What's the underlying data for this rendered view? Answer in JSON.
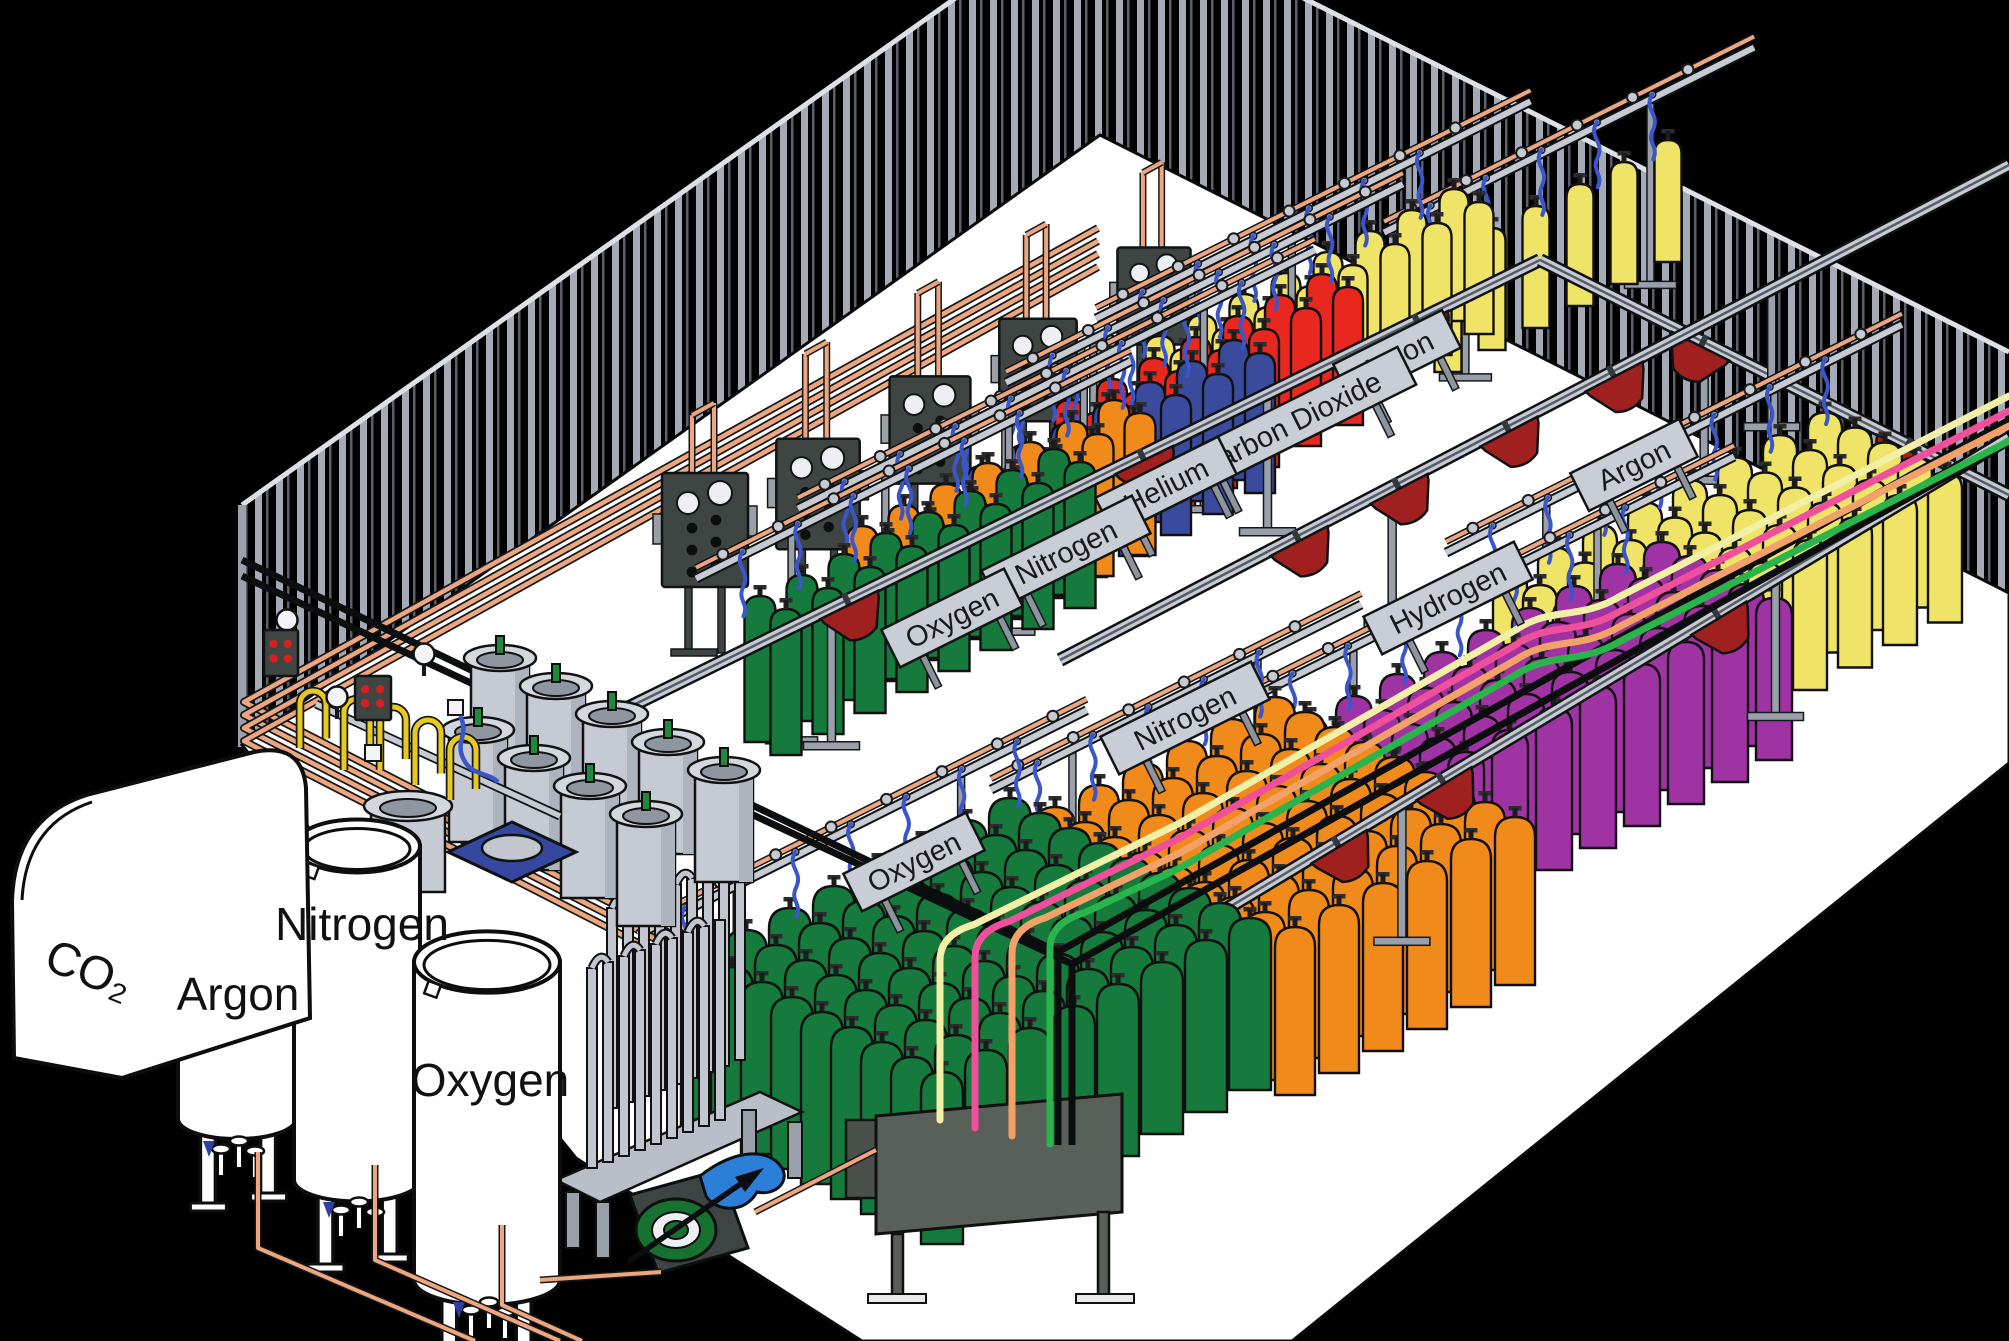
{
  "diagram": {
    "storage_tanks": [
      {
        "id": "co2-tank",
        "label": "CO₂"
      },
      {
        "id": "argon-tank",
        "label": "Argon"
      },
      {
        "id": "nitrogen-tank",
        "label": "Nitrogen"
      },
      {
        "id": "oxygen-tank",
        "label": "Oxygen"
      }
    ],
    "filling_rows": [
      {
        "id": "argon-back",
        "gas": "Argon",
        "label": "Argon",
        "cylinder_color": "#F0E468"
      },
      {
        "id": "carbon-dioxide",
        "gas": "Carbon Dioxide",
        "label": "Carbon Dioxide",
        "cylinder_color": "#F0E468"
      },
      {
        "id": "helium",
        "gas": "Helium",
        "label": "Helium",
        "cylinder_color": "#E8281E"
      },
      {
        "id": "nitrogen-back",
        "gas": "Nitrogen",
        "label": "Nitrogen",
        "cylinder_color": "#3A4A9C"
      },
      {
        "id": "nitrogen-mid",
        "gas": "Nitrogen",
        "label": "",
        "cylinder_color": "#F08A1A"
      },
      {
        "id": "oxygen-back",
        "gas": "Oxygen",
        "label": "Oxygen",
        "cylinder_color": "#157A3C"
      },
      {
        "id": "argon-right",
        "gas": "Argon",
        "label": "Argon",
        "cylinder_color": "#F0E468"
      },
      {
        "id": "hydrogen",
        "gas": "Hydrogen",
        "label": "Hydrogen",
        "cylinder_color": "#A033A4"
      },
      {
        "id": "nitrogen-front",
        "gas": "Nitrogen",
        "label": "Nitrogen",
        "cylinder_color": "#F08A1A"
      },
      {
        "id": "oxygen-front",
        "gas": "Oxygen",
        "label": "Oxygen",
        "cylinder_color": "#157A3C"
      }
    ],
    "supply_lines": [
      {
        "name": "supply-line-cream",
        "color": "#F2EFA6"
      },
      {
        "name": "supply-line-pink",
        "color": "#F0509B"
      },
      {
        "name": "supply-line-peach",
        "color": "#F2A268"
      },
      {
        "name": "supply-line-green",
        "color": "#2AB44C"
      }
    ],
    "palette": {
      "background": "#000000",
      "wall_stripe": "#A4ABB6",
      "floor": "#FFFFFF",
      "copper_pipe": "#EDA67E",
      "yellow_pipe": "#E8C91E",
      "hose_blue": "#3A56C8",
      "rail_gray": "#C6CBD3",
      "panel_dark": "#3F4542",
      "cart_red": "#A02020",
      "tank_white": "#FFFFFF",
      "dewar_gray": "#C6CBD3",
      "black_pipe": "#0B0D0E"
    }
  }
}
